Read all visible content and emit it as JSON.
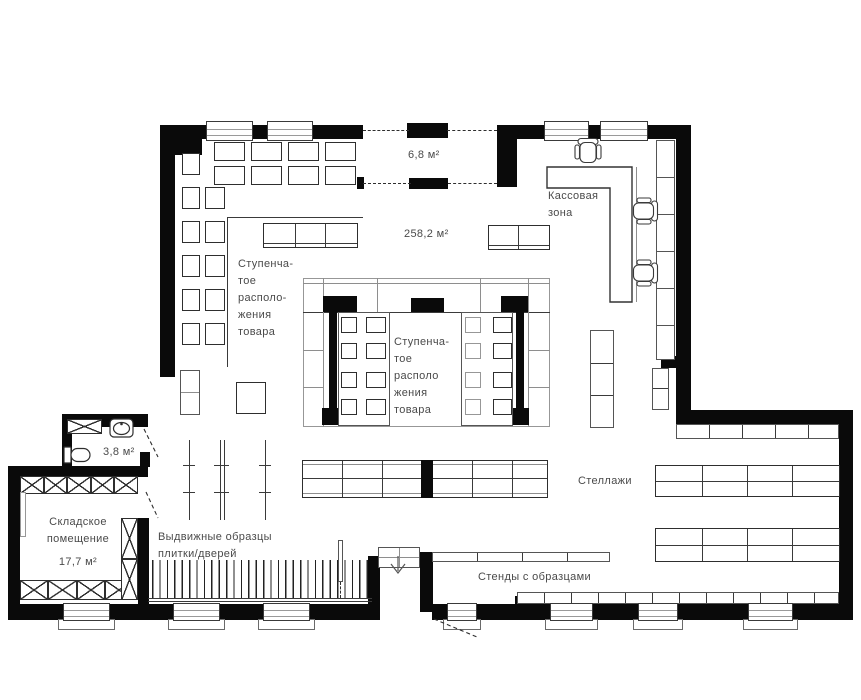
{
  "plan": {
    "colors": {
      "wall": "#0a0a0a",
      "line": "#3a3a3a",
      "text": "#4a4a4a"
    },
    "rooms": {
      "vestibule_area": "6,8 м²",
      "hall_area": "258,2 м²",
      "wc_area": "3,8 м²",
      "storage": {
        "line1": "Складское",
        "line2": "помещение",
        "area": "17,7 м²"
      }
    },
    "labels": {
      "cash_line1": "Кассовая",
      "cash_line2": "зона",
      "stepped_left": {
        "l1": "Ступенча-",
        "l2": "тое",
        "l3": "располо-",
        "l4": "жения",
        "l5": "товара"
      },
      "stepped_center": {
        "l1": "Ступенча-",
        "l2": "тое",
        "l3": "располо",
        "l4": "жения",
        "l5": "товара"
      },
      "shelving": "Стеллажи",
      "pullout_line1": "Выдвижные образцы",
      "pullout_line2": "плитки/дверей",
      "stands": "Стенды с образцами"
    },
    "icons": [
      "office-chair-icon",
      "toilet-icon",
      "sink-icon",
      "stairs-down-arrow-icon",
      "door-swing",
      "crossed-storage-rack"
    ]
  }
}
